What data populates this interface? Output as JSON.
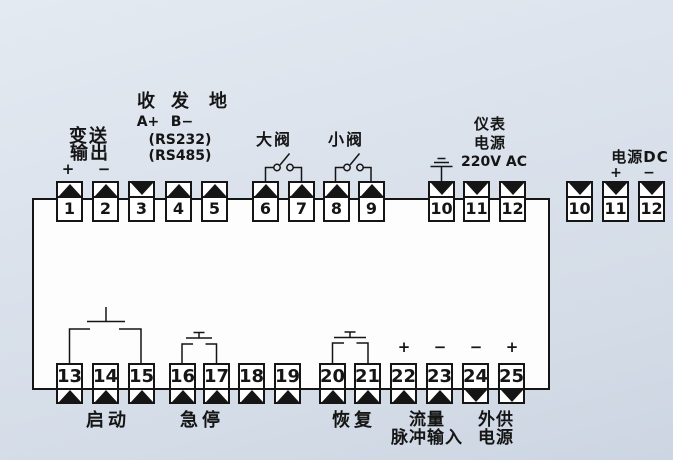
{
  "colors": {
    "background": "#d9e0ea",
    "panel": "#fdfdfd",
    "line": "#151515"
  },
  "icons": {
    "arrow_up": "black triangle pointing up",
    "arrow_down": "black triangle pointing down",
    "valve_switch": "normally-open contact with two circles and lever",
    "pushbutton": "momentary pushbutton contact",
    "earth_ground": "earth ground (three bars)"
  },
  "top": {
    "terminals": [
      {
        "num": "1",
        "arrow": "up"
      },
      {
        "num": "2",
        "arrow": "up"
      },
      {
        "num": "3",
        "arrow": "down"
      },
      {
        "num": "4",
        "arrow": "up"
      },
      {
        "num": "5",
        "arrow": "up"
      },
      {
        "num": "6",
        "arrow": "up"
      },
      {
        "num": "7",
        "arrow": "up"
      },
      {
        "num": "8",
        "arrow": "up"
      },
      {
        "num": "9",
        "arrow": "up"
      },
      {
        "num": "10",
        "arrow": "down"
      },
      {
        "num": "11",
        "arrow": "down"
      },
      {
        "num": "12",
        "arrow": "down"
      }
    ]
  },
  "dc": {
    "terminals": [
      {
        "num": "10",
        "arrow": "down"
      },
      {
        "num": "11",
        "arrow": "down"
      },
      {
        "num": "12",
        "arrow": "down"
      }
    ]
  },
  "bottom": {
    "terminals": [
      {
        "num": "13",
        "arrow": "up"
      },
      {
        "num": "14",
        "arrow": "up"
      },
      {
        "num": "15",
        "arrow": "up"
      },
      {
        "num": "16",
        "arrow": "up"
      },
      {
        "num": "17",
        "arrow": "up"
      },
      {
        "num": "18",
        "arrow": "up"
      },
      {
        "num": "19",
        "arrow": "up"
      },
      {
        "num": "20",
        "arrow": "up"
      },
      {
        "num": "21",
        "arrow": "up"
      },
      {
        "num": "22",
        "arrow": "up"
      },
      {
        "num": "23",
        "arrow": "up"
      },
      {
        "num": "24",
        "arrow": "down"
      },
      {
        "num": "25",
        "arrow": "down"
      }
    ]
  },
  "labels": {
    "transmit_line1": "变送",
    "transmit_line2": "输出",
    "plus": "+",
    "minus": "−",
    "recv": "收",
    "send": "发",
    "gnd": "地",
    "a_plus": "A+",
    "b_minus": "B−",
    "rs232": "(RS232)",
    "rs485": "(RS485)",
    "big_valve": "大阀",
    "small_valve": "小阀",
    "meter1": "仪表",
    "meter2": "电源",
    "meter3": "220V AC",
    "power_dc": "电源DC",
    "start": "启动",
    "estop": "急停",
    "resume": "恢复",
    "flow1": "流量",
    "flow2": "脉冲输入",
    "ext1": "外供",
    "ext2": "电源"
  }
}
